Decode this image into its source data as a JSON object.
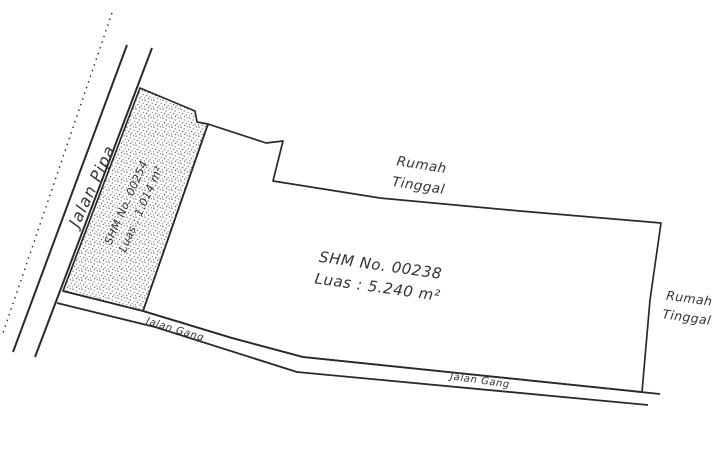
{
  "colors": {
    "ink": "#2a2a2a",
    "paper": "#ffffff",
    "stipple_dots": "#555555"
  },
  "roads": {
    "jalan_pipa": {
      "label": "Jalan Pipa"
    },
    "jalan_gang_west": {
      "label": "Jalan Gang"
    },
    "jalan_gang_east": {
      "label": "Jalan Gang"
    }
  },
  "parcels": {
    "parcel_00254": {
      "title": "SHM No. 00254",
      "area": "Luas : 1.014 m²"
    },
    "parcel_00238": {
      "title": "SHM No. 00238",
      "area": "Luas : 5.240 m²"
    }
  },
  "adjacent": {
    "north": {
      "line1": "Rumah",
      "line2": "Tinggal"
    },
    "east": {
      "line1": "Rumah",
      "line2": "Tinggal"
    }
  }
}
